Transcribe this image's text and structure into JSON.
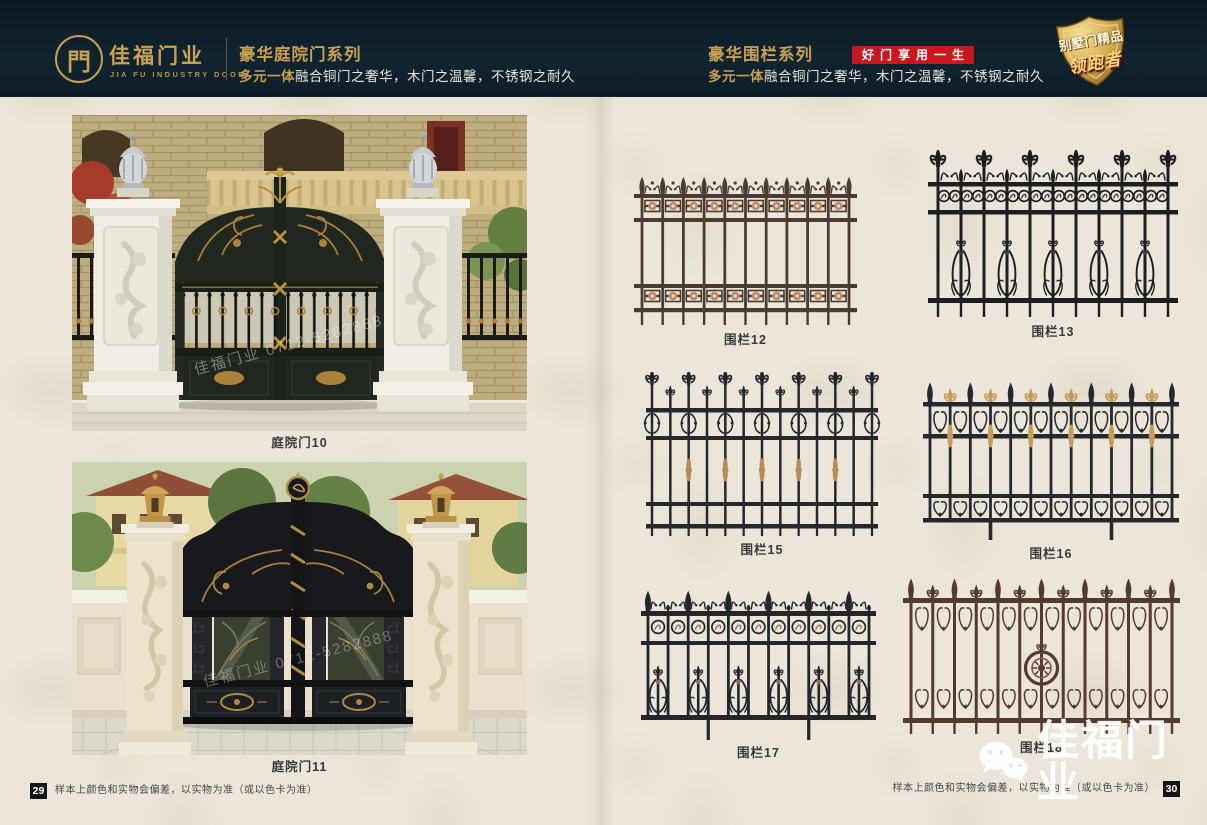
{
  "colors": {
    "gold": "#c9a052",
    "badge_red": "#c8181d",
    "header_bg": "#0d1d26",
    "page_bg": "#ebe6d9"
  },
  "header": {
    "logo": {
      "glyph": "門",
      "brand_cn": "佳福门业",
      "brand_en": "JIA FU INDUSTRY DOOR"
    },
    "series_left": {
      "title": "豪华庭院门系列",
      "subtitle_em": "多元一体",
      "subtitle_rest": "融合铜门之奢华，木门之温馨，不锈钢之耐久"
    },
    "series_right": {
      "title": "豪华围栏系列",
      "slogan": "好门享用一生",
      "subtitle_em": "多元一体",
      "subtitle_rest": "融合铜门之奢华，木门之温馨，不锈钢之耐久"
    },
    "badge": {
      "line1": "别墅门精品",
      "line2": "领跑者"
    }
  },
  "products": {
    "gates": [
      {
        "label": "庭院门10"
      },
      {
        "label": "庭院门11"
      }
    ],
    "fences": [
      {
        "label": "围栏12"
      },
      {
        "label": "围栏13"
      },
      {
        "label": "围栏15"
      },
      {
        "label": "围栏16"
      },
      {
        "label": "围栏17"
      },
      {
        "label": "围栏18"
      }
    ]
  },
  "footer": {
    "page_left": "29",
    "page_right": "30",
    "disclaimer": "样本上颜色和实物会偏差，以实物为准（或以色卡为准）"
  },
  "watermark": {
    "brand": "佳福门业",
    "photo": "佳福门业 0712-5282888"
  }
}
